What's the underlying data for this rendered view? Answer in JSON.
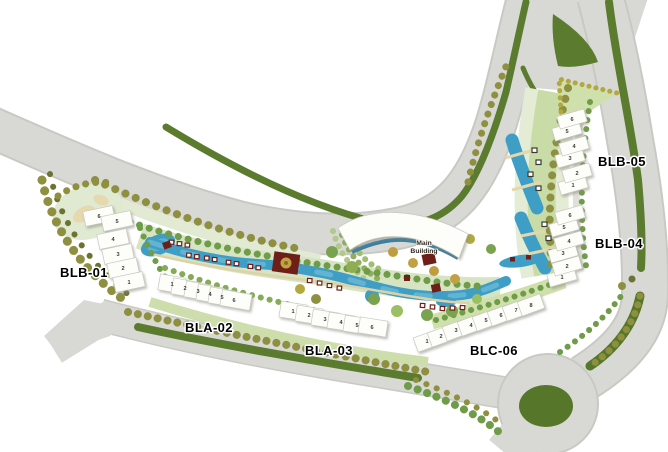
{
  "plan": {
    "blocks": {
      "blb01": {
        "label": "BLB-01",
        "units": [
          "1",
          "2",
          "3",
          "4",
          "5",
          "6"
        ]
      },
      "bla02": {
        "label": "BLA-02",
        "units": [
          "1",
          "2",
          "3",
          "4",
          "5",
          "6"
        ]
      },
      "bla03": {
        "label": "BLA-03",
        "units": [
          "1",
          "2",
          "3",
          "4",
          "5",
          "6"
        ]
      },
      "blc06": {
        "label": "BLC-06",
        "units": [
          "1",
          "2",
          "3",
          "4",
          "5",
          "6",
          "7",
          "8"
        ]
      },
      "blb04": {
        "label": "BLB-04",
        "units": [
          "1",
          "2",
          "3",
          "4",
          "5",
          "6"
        ]
      },
      "blb05": {
        "label": "BLB-05",
        "units": [
          "1",
          "2",
          "3",
          "4",
          "5",
          "6"
        ]
      }
    },
    "main_building": {
      "line1": "Main",
      "line2": "Building"
    },
    "palette": {
      "road": "#d8d8d5",
      "road_edge": "#c9c9c4",
      "median_green": "#5b7b2e",
      "roundabout_green": "#567729",
      "pool_blue": "#3f9ec6",
      "lawn_light": "#cfe0ad",
      "lawn_pale": "#e4ecd6",
      "tree_olive": "#8e9040",
      "tree_green": "#6f9c49",
      "building_white": "#fdfdfa",
      "pavilion_red": "#6e2018",
      "accent_gold": "#c2a044",
      "label_black": "#000000"
    }
  }
}
